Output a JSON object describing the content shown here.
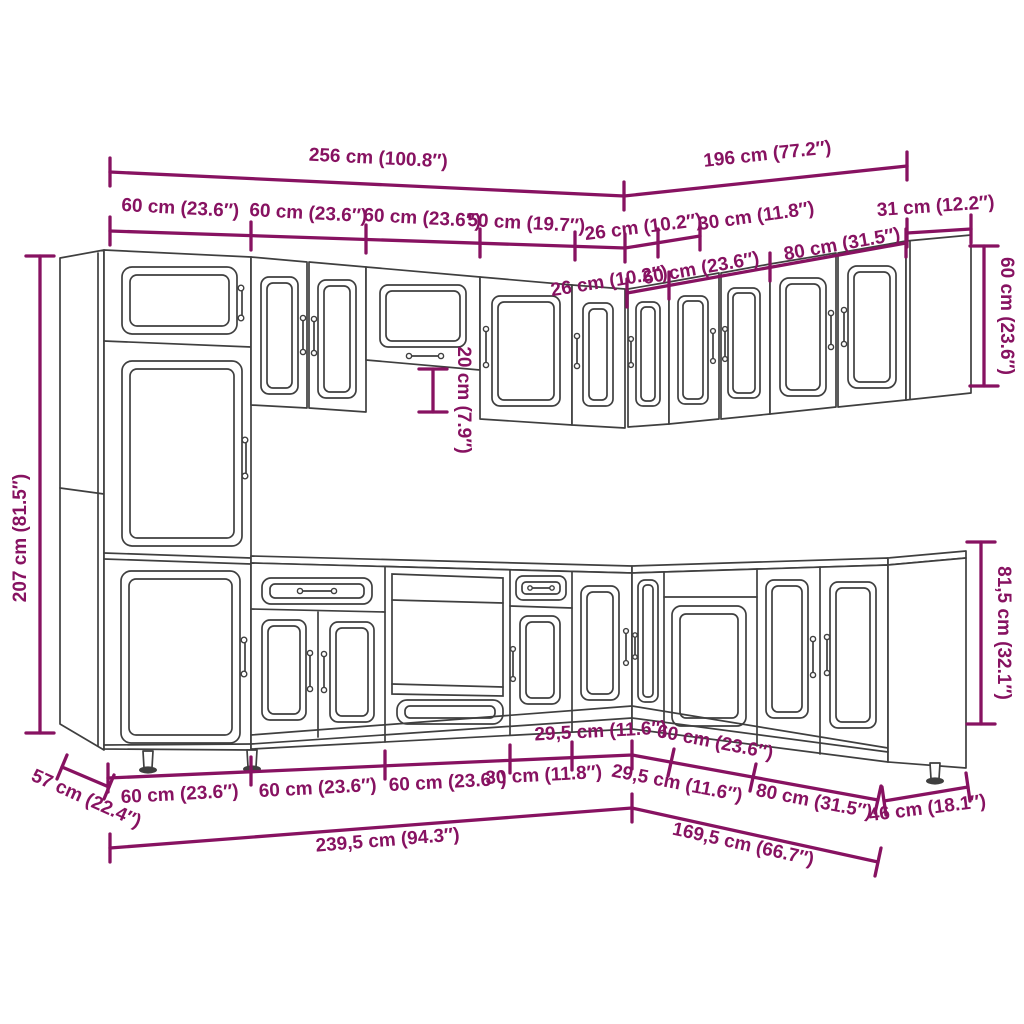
{
  "diagram": {
    "title": "L-shaped kitchen cabinet set dimension drawing",
    "colors": {
      "dimension_accent": "#871261",
      "cabinet_outline": "#3f3f3f",
      "background": "#ffffff"
    }
  },
  "dims": {
    "total_left_width": "256 cm (100.8″)",
    "total_right_width": "196 cm (77.2″)",
    "wall_left_1": "60 cm (23.6″)",
    "wall_left_2": "60 cm (23.6″)",
    "wall_left_3": "60 cm (23.6″)",
    "wall_left_4": "50 cm (19.7″)",
    "wall_corner_left": "26 cm (10.2″)",
    "wall_corner_right": "30 cm (11.8″)",
    "wall_end_depth": "31 cm (12.2″)",
    "wall_right_1": "26 cm (10.2″)",
    "wall_right_2": "60 cm (23.6″)",
    "wall_right_3": "80 cm (31.5″)",
    "tall_cabinet_height": "207 cm (81.5″)",
    "wall_cabinet_height": "60 cm (23.6″)",
    "bridge_gap_height": "20 cm (7.9″)",
    "base_cabinet_height": "81,5 cm (32.1″)",
    "base_depth_left": "57 cm (22.4″)",
    "base_left_1": "60 cm (23.6″)",
    "base_left_2": "60 cm (23.6″)",
    "base_left_3": "60 cm (23.6″)",
    "base_left_4": "30 cm (11.8″)",
    "base_left_5": "29,5 cm (11.6″)",
    "base_right_1": "29,5 cm (11.6″)",
    "base_right_2": "60 cm (23.6″)",
    "base_right_3": "80 cm (31.5″)",
    "base_end_depth": "46 cm (18.1″)",
    "base_total_left": "239,5 cm (94.3″)",
    "base_total_right": "169,5 cm (66.7″)"
  }
}
